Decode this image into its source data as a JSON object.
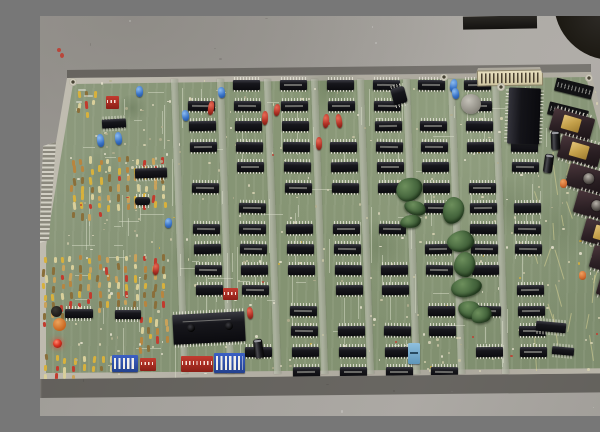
{
  "meta": {
    "description": "Photograph of a vintage green arcade printed circuit board covered with rows of black DIP logic chips, a column of ceramic EPROMs with gold and white labels on the right, blue and red capacitors, DIP switches, resistor banks, a white top edge connector and scattered dark-green putty blobs, lying on a gray concrete floor",
    "type": "photograph",
    "visible_text": ""
  },
  "palette": {
    "floor": "#a3a09b",
    "board_green": "#849372",
    "edge_silver": "#b4b0a5",
    "ic_black": "#17171c",
    "eprom_body": "#2a1f23",
    "eprom_gold": "#c4a04a",
    "eprom_white": "#e6dfc9",
    "cap_blue": "#3a74c8",
    "cap_red": "#b23226",
    "dip_switch_blue": "#2c4da8",
    "blob_green": "#4a6b41",
    "connector_beige": "#d9cfae",
    "led_red": "#dd3322"
  },
  "scene": {
    "seed": 1234,
    "board": {
      "outline": [
        [
          27,
          62
        ],
        [
          436,
          58
        ],
        [
          438,
          52
        ],
        [
          500,
          51
        ],
        [
          502,
          57
        ],
        [
          551,
          56
        ],
        [
          600,
          246
        ],
        [
          600,
          357
        ],
        [
          0,
          363
        ],
        [
          0,
          203
        ],
        [
          3,
          130
        ],
        [
          16,
          126
        ]
      ],
      "inner": [
        [
          33,
          68
        ],
        [
          546,
          61
        ],
        [
          595,
          248
        ],
        [
          594,
          352
        ],
        [
          6,
          357
        ],
        [
          6,
          230
        ]
      ],
      "edge_tab": [
        [
          16,
          126
        ],
        [
          3,
          130
        ],
        [
          0,
          203
        ],
        [
          0,
          227
        ],
        [
          9,
          224
        ]
      ],
      "buses": {
        "xs": [
          136,
          182,
          229,
          276,
          322,
          368,
          413,
          457
        ],
        "y0": 63,
        "y1": 358,
        "w": 7,
        "rot": -2
      },
      "ic_grid": {
        "row0_y": 64,
        "pitch": 20.5,
        "w": 27,
        "h": 9.5,
        "lean": 0.045,
        "columns": [
          {
            "x": 147,
            "rows": [
              1,
              2,
              3,
              5,
              7,
              8,
              9,
              10
            ]
          },
          {
            "x": 193,
            "rows": [
              0,
              1,
              2,
              3,
              4,
              6,
              7,
              8,
              9,
              10,
              13
            ]
          },
          {
            "x": 240,
            "rows": [
              0,
              1,
              2,
              3,
              4,
              5,
              7,
              8,
              9,
              11,
              12,
              13,
              14
            ]
          },
          {
            "x": 287,
            "rows": [
              0,
              1,
              3,
              4,
              5,
              7,
              8,
              9,
              10,
              12,
              13,
              14
            ]
          },
          {
            "x": 333,
            "rows": [
              0,
              1,
              2,
              3,
              4,
              5,
              7,
              9,
              10,
              12,
              13,
              14
            ]
          },
          {
            "x": 378,
            "rows": [
              0,
              2,
              3,
              4,
              5,
              6,
              8,
              9,
              11,
              12,
              14
            ]
          },
          {
            "x": 424,
            "rows": [
              0,
              1,
              2,
              3,
              5,
              6,
              7,
              8,
              9,
              11,
              13
            ]
          },
          {
            "x": 468,
            "rows": [
              1,
              2,
              3,
              4,
              6,
              7,
              8,
              10,
              11,
              12,
              13
            ]
          }
        ]
      },
      "extra_ics": [
        [
          62,
          103,
          24,
          9,
          -3
        ],
        [
          95,
          152,
          32,
          10,
          -2
        ],
        [
          25,
          293,
          28,
          9,
          0
        ],
        [
          75,
          294,
          26,
          9,
          0
        ],
        [
          496,
          306,
          30,
          10,
          5
        ],
        [
          512,
          331,
          22,
          8,
          5
        ]
      ],
      "cpu_main": {
        "x": 133,
        "y": 297,
        "w": 72,
        "h": 30,
        "rot": -3
      },
      "cpu_top": {
        "x": 468,
        "y": 72,
        "w": 32,
        "h": 56,
        "rot": 2
      },
      "connector_top": {
        "x": 437,
        "y": 54,
        "w": 64,
        "h": 14,
        "rot": -1
      },
      "crystal": {
        "x": 421,
        "y": 78,
        "d": 20
      },
      "sockets": [
        [
          515,
          66,
          38,
          13,
          14
        ],
        [
          508,
          90,
          40,
          13,
          14
        ]
      ],
      "eproms": [
        {
          "x": 511,
          "y": 97,
          "style": "gold"
        },
        {
          "x": 519,
          "y": 124,
          "style": "gold"
        },
        {
          "x": 527,
          "y": 152,
          "style": "window"
        },
        {
          "x": 535,
          "y": 179,
          "style": "window"
        },
        {
          "x": 543,
          "y": 207,
          "style": "gold"
        },
        {
          "x": 551,
          "y": 234,
          "style": "window"
        },
        {
          "x": 558,
          "y": 261,
          "style": "white"
        },
        {
          "x": 564,
          "y": 288,
          "style": "white"
        },
        {
          "x": 570,
          "y": 315,
          "style": "gold"
        },
        {
          "x": 574,
          "y": 336,
          "style": "white"
        }
      ],
      "eprom_size": {
        "w": 42,
        "h": 23,
        "rot": 16
      },
      "dip_switches": [
        [
          72,
          339,
          26,
          17
        ],
        [
          174,
          337,
          31,
          20
        ]
      ],
      "red_packs": [
        [
          141,
          340,
          32,
          16
        ],
        [
          100,
          342,
          16,
          13
        ],
        [
          66,
          80,
          13,
          13
        ],
        [
          183,
          272,
          15,
          12
        ]
      ],
      "caps_blue": [
        [
          96,
          70
        ],
        [
          178,
          71
        ],
        [
          142,
          94
        ],
        [
          410,
          63
        ],
        [
          412,
          72
        ],
        [
          125,
          202
        ],
        [
          57,
          118
        ],
        [
          75,
          116
        ]
      ],
      "caps_red": [
        [
          283,
          98
        ],
        [
          296,
          98
        ],
        [
          276,
          121
        ],
        [
          234,
          88
        ],
        [
          222,
          95
        ],
        [
          207,
          291
        ],
        [
          168,
          85
        ],
        [
          113,
          247
        ]
      ],
      "caps_orange": [
        [
          520,
          163
        ],
        [
          539,
          255
        ]
      ],
      "electrolytics": [
        [
          511,
          115
        ],
        [
          504,
          138
        ],
        [
          214,
          323
        ]
      ],
      "led": {
        "x": 13,
        "y": 323,
        "d": 9
      },
      "discs": [
        {
          "x": 11,
          "y": 290,
          "d": 11,
          "color": "#1c1a18"
        },
        {
          "x": 13,
          "y": 302,
          "d": 13,
          "color": "#d9712f"
        }
      ],
      "trimmer": {
        "x": 368,
        "y": 327,
        "w": 12,
        "h": 21
      },
      "misc_black": [
        [
          95,
          181,
          15,
          8,
          0
        ],
        [
          352,
          71,
          14,
          17,
          -15
        ]
      ],
      "green_blobs": [
        [
          356,
          162,
          27,
          23,
          -18
        ],
        [
          364,
          185,
          22,
          14,
          14
        ],
        [
          360,
          199,
          21,
          13,
          -8
        ],
        [
          403,
          181,
          21,
          27,
          8
        ],
        [
          407,
          215,
          27,
          21,
          -14
        ],
        [
          414,
          236,
          21,
          25,
          4
        ],
        [
          411,
          262,
          31,
          19,
          -6
        ],
        [
          418,
          285,
          23,
          18,
          10
        ],
        [
          431,
          291,
          21,
          16,
          -22
        ]
      ],
      "resistor_fields": [
        {
          "x": 30,
          "y": 140,
          "w": 100,
          "h": 92,
          "n": 70
        },
        {
          "x": 28,
          "y": 238,
          "w": 102,
          "h": 95,
          "n": 70
        },
        {
          "x": 2,
          "y": 240,
          "w": 26,
          "h": 95,
          "n": 22
        },
        {
          "x": 4,
          "y": 338,
          "w": 92,
          "h": 20,
          "n": 24
        },
        {
          "x": 36,
          "y": 74,
          "w": 24,
          "h": 20,
          "n": 8
        },
        {
          "x": 98,
          "y": 300,
          "w": 34,
          "h": 34,
          "n": 14
        }
      ],
      "stains": [
        [
          290,
          70,
          70,
          60,
          0.2
        ],
        [
          92,
          92,
          34,
          26,
          0.22
        ],
        [
          340,
          230,
          60,
          50,
          0.16
        ],
        [
          470,
          190,
          50,
          70,
          0.14
        ],
        [
          150,
          245,
          50,
          45,
          0.14
        ],
        [
          520,
          210,
          60,
          80,
          0.12
        ],
        [
          60,
          160,
          40,
          60,
          0.12
        ]
      ],
      "holes": [
        [
          549,
          62
        ],
        [
          461,
          71
        ],
        [
          33,
          66
        ],
        [
          404,
          61
        ]
      ],
      "silkscreen": [
        [
          38,
          73
        ],
        [
          44,
          79
        ],
        [
          36,
          85
        ]
      ],
      "solder_dots": {
        "count": 380
      },
      "traces": {
        "vertical": 70,
        "horizontal": 40,
        "yellow_right": 22
      }
    },
    "floor_objects": {
      "dark_rect": {
        "x": 423,
        "y": 0,
        "w": 74,
        "h": 13
      },
      "round_object": {
        "cx": 572,
        "cy": -14,
        "r": 58
      },
      "glint": {
        "x": 580,
        "y": 6,
        "w": 16,
        "h": 5,
        "rot": 10
      },
      "red_specks": [
        [
          17,
          32,
          4,
          4
        ],
        [
          20,
          37,
          4,
          5
        ]
      ],
      "scuffs": 60
    },
    "shadows": {
      "bottom": [
        [
          0,
          363
        ],
        [
          600,
          357
        ],
        [
          600,
          376
        ],
        [
          0,
          382
        ]
      ],
      "top": [
        [
          27,
          54
        ],
        [
          551,
          48
        ],
        [
          551,
          56
        ],
        [
          27,
          62
        ]
      ]
    }
  }
}
